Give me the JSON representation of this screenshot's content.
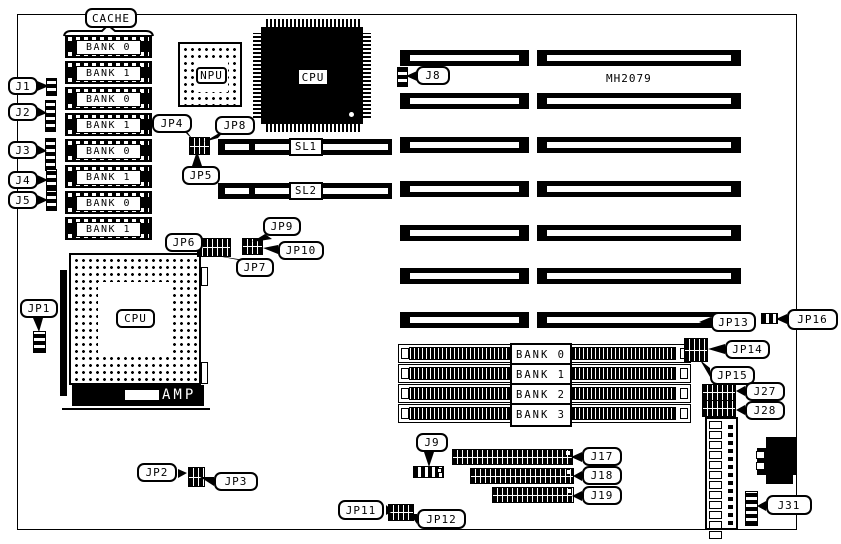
{
  "board": {
    "part_number": "MH2079",
    "cpu_socket_brand": "AMP"
  },
  "labels": {
    "cache": "CACHE",
    "npu": "NPU",
    "cpu_qfp": "CPU",
    "cpu_socket": "CPU",
    "sl1": "SL1",
    "sl2": "SL2",
    "j1": "J1",
    "j2": "J2",
    "j3": "J3",
    "j4": "J4",
    "j5": "J5",
    "j8": "J8",
    "j9": "J9",
    "j17": "J17",
    "j18": "J18",
    "j19": "J19",
    "j27": "J27",
    "j28": "J28",
    "j31": "J31",
    "jp1": "JP1",
    "jp2": "JP2",
    "jp3": "JP3",
    "jp4": "JP4",
    "jp5": "JP5",
    "jp6": "JP6",
    "jp7": "JP7",
    "jp8": "JP8",
    "jp9": "JP9",
    "jp10": "JP10",
    "jp11": "JP11",
    "jp12": "JP12",
    "jp13": "JP13",
    "jp14": "JP14",
    "jp15": "JP15",
    "jp16": "JP16"
  },
  "cache_chips": [
    "BANK 0",
    "BANK 1",
    "BANK 0",
    "BANK 1",
    "BANK 0",
    "BANK 1",
    "BANK 0",
    "BANK 1"
  ],
  "simm_banks": [
    "BANK 0",
    "BANK 1",
    "BANK 2",
    "BANK 3"
  ]
}
